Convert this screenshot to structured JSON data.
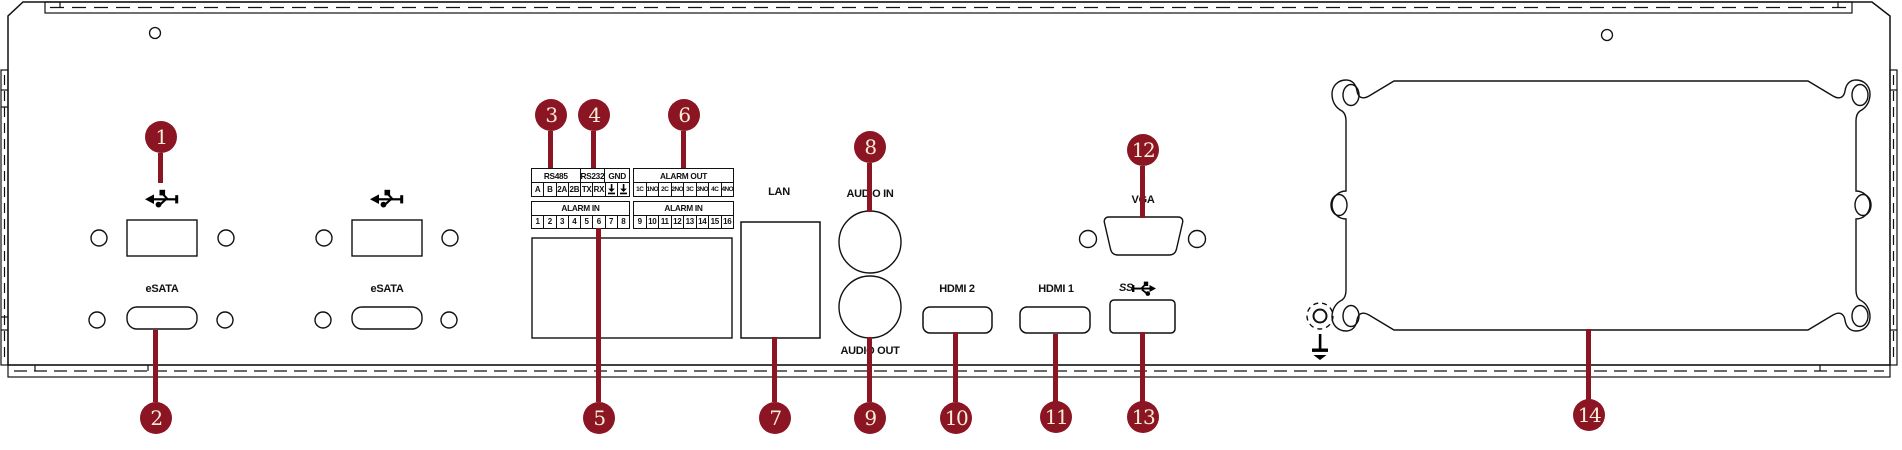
{
  "diagram": {
    "type": "device-rear-panel",
    "labels": {
      "esata1": "eSATA",
      "esata2": "eSATA",
      "lan": "LAN",
      "audio_in": "AUDIO IN",
      "audio_out": "AUDIO OUT",
      "hdmi2": "HDMI 2",
      "hdmi1": "HDMI 1",
      "vga": "VGA",
      "usb3": "SS"
    },
    "terminal": {
      "rs_header": [
        "RS485",
        "RS232",
        "GND"
      ],
      "rs_cells": [
        "A",
        "B",
        "2A",
        "2B",
        "TX",
        "RX"
      ],
      "alarm_out": {
        "title": "ALARM OUT",
        "cells": [
          "1C",
          "1NO",
          "2C",
          "2NO",
          "3C",
          "3NO",
          "4C",
          "4NO"
        ]
      },
      "alarm_in_a": {
        "title": "ALARM IN",
        "cells": [
          "1",
          "2",
          "3",
          "4",
          "5",
          "6",
          "7",
          "8"
        ]
      },
      "alarm_in_b": {
        "title": "ALARM IN",
        "cells": [
          "9",
          "10",
          "11",
          "12",
          "13",
          "14",
          "15",
          "16"
        ]
      }
    },
    "callouts": [
      "1",
      "2",
      "3",
      "4",
      "5",
      "6",
      "7",
      "8",
      "9",
      "10",
      "11",
      "12",
      "13",
      "14"
    ],
    "colors": {
      "callout_red": "#8c1523",
      "callout_text": "#f6edd8",
      "line": "#111111"
    }
  }
}
